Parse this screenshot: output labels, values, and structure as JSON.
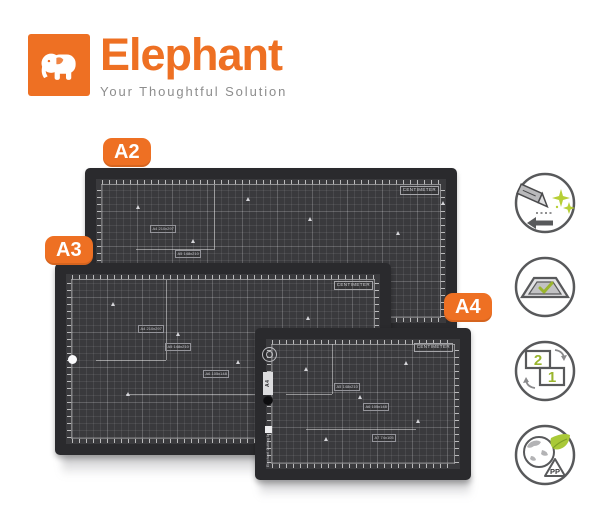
{
  "brand": {
    "name": "Elephant",
    "tagline": "Your Thoughtful Solution",
    "logo_icon": "elephant-icon",
    "colors": {
      "orange": "#EE7023",
      "tagline_gray": "#8D8D8D"
    }
  },
  "size_badges": [
    {
      "label": "A2"
    },
    {
      "label": "A3"
    },
    {
      "label": "A4"
    }
  ],
  "mats": {
    "a2": {
      "unit_label": "CENTIMETER",
      "size_labels": [
        "A4 210x297",
        "A5 148x210"
      ]
    },
    "a3": {
      "unit_label": "CENTIMETER",
      "size_labels": [
        "A4 210x297",
        "A5 148x210",
        "A6 105x148"
      ]
    },
    "a4": {
      "unit_label": "CENTIMETER",
      "side_size": "A4",
      "edge_brand": "Elephant Cutting Mat",
      "size_labels": [
        "A5 148x210",
        "A6 105x148",
        "A7 74x105"
      ]
    }
  },
  "features": [
    {
      "icon": "smooth-cutting-icon"
    },
    {
      "icon": "self-healing-mat-icon"
    },
    {
      "icon": "two-sided-icon",
      "labels": [
        "2",
        "1"
      ]
    },
    {
      "icon": "eco-pp-icon",
      "label": "PP"
    }
  ],
  "colors": {
    "mat_frame": "#2A2A2D",
    "mat_surface": "#3A3A3D",
    "grid_line": "#4B4B4F",
    "accent_green": "#A9C938",
    "icon_stroke": "#58595B"
  }
}
